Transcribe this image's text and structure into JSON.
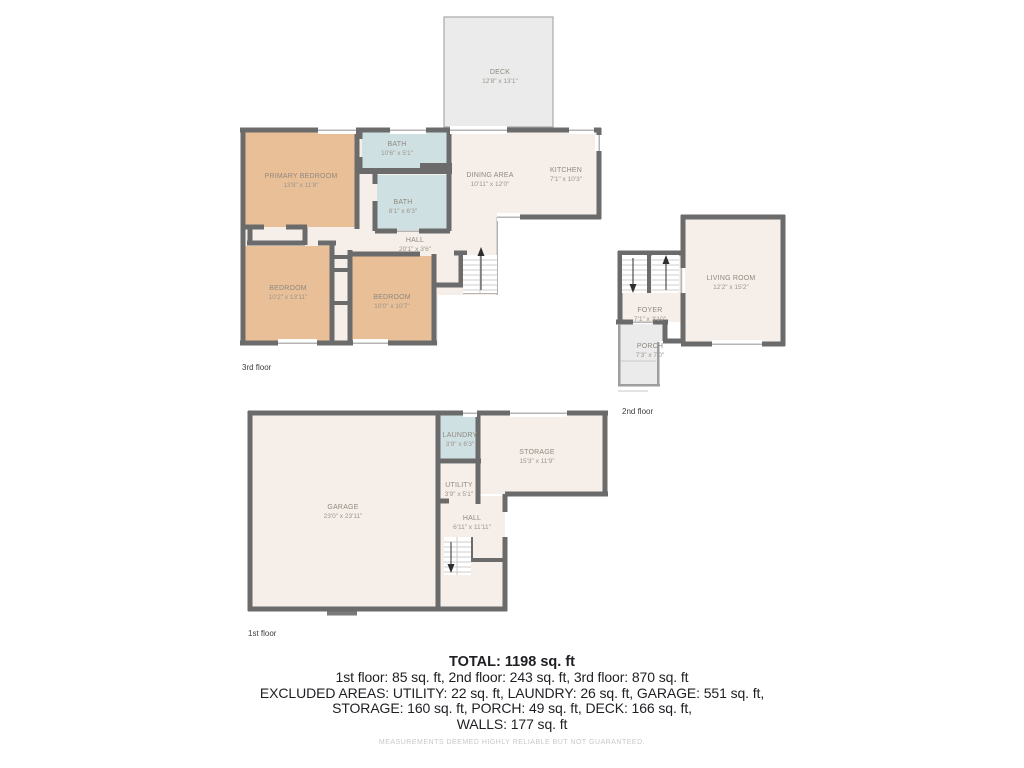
{
  "floors": [
    {
      "label": "3rd floor",
      "rooms": [
        {
          "name": "DECK",
          "dims": "12'8\" x 13'1\""
        },
        {
          "name": "PRIMARY BEDROOM",
          "dims": "13'8\" x 11'8\""
        },
        {
          "name": "BATH",
          "dims": "10'6\" x 5'1\""
        },
        {
          "name": "BATH",
          "dims": "8'1\" x 6'3\""
        },
        {
          "name": "DINING AREA",
          "dims": "10'11\" x 12'0\""
        },
        {
          "name": "KITCHEN",
          "dims": "7'1\" x 10'3\""
        },
        {
          "name": "HALL",
          "dims": "20'1\" x 3'6\""
        },
        {
          "name": "BEDROOM",
          "dims": "10'2\" x 13'11\""
        },
        {
          "name": "BEDROOM",
          "dims": "10'0\" x 10'7\""
        }
      ]
    },
    {
      "label": "2nd floor",
      "rooms": [
        {
          "name": "LIVING ROOM",
          "dims": "12'2\" x 15'2\""
        },
        {
          "name": "FOYER",
          "dims": "7'1\" x 3'10\""
        },
        {
          "name": "PORCH",
          "dims": "7'3\" x 7'0\""
        }
      ]
    },
    {
      "label": "1st floor",
      "rooms": [
        {
          "name": "GARAGE",
          "dims": "23'0\" x 23'11\""
        },
        {
          "name": "LAUNDRY",
          "dims": "3'9\" x 6'3\""
        },
        {
          "name": "UTILITY",
          "dims": "3'9\" x 5'1\""
        },
        {
          "name": "STORAGE",
          "dims": "15'3\" x 11'9\""
        },
        {
          "name": "HALL",
          "dims": "6'11\" x 11'11\""
        }
      ]
    }
  ],
  "summary": {
    "total": "TOTAL: 1198 sq. ft",
    "floors_line": "1st floor: 85 sq. ft, 2nd floor: 243 sq. ft, 3rd floor: 870 sq. ft",
    "excluded_line1": "EXCLUDED AREAS: UTILITY: 22 sq. ft, LAUNDRY: 26 sq. ft, GARAGE: 551 sq. ft,",
    "excluded_line2": "STORAGE: 160 sq. ft, PORCH: 49 sq. ft, DECK: 166 sq. ft,",
    "excluded_line3": "WALLS: 177 sq. ft",
    "disclaimer": "MEASUREMENTS DEEMED HIGHLY RELIABLE BUT NOT GUARANTEED."
  },
  "palette": {
    "wall": "#6b6b6b",
    "floor_beige": "#f6eee8",
    "bedroom_tan": "#e9bf97",
    "bath_blue": "#cfe0e2",
    "outdoor_gray": "#ebebeb",
    "room_label_gray": "#8f897f",
    "summary_text": "#1f1f23",
    "disclaimer_gray": "#c8c8c8"
  }
}
